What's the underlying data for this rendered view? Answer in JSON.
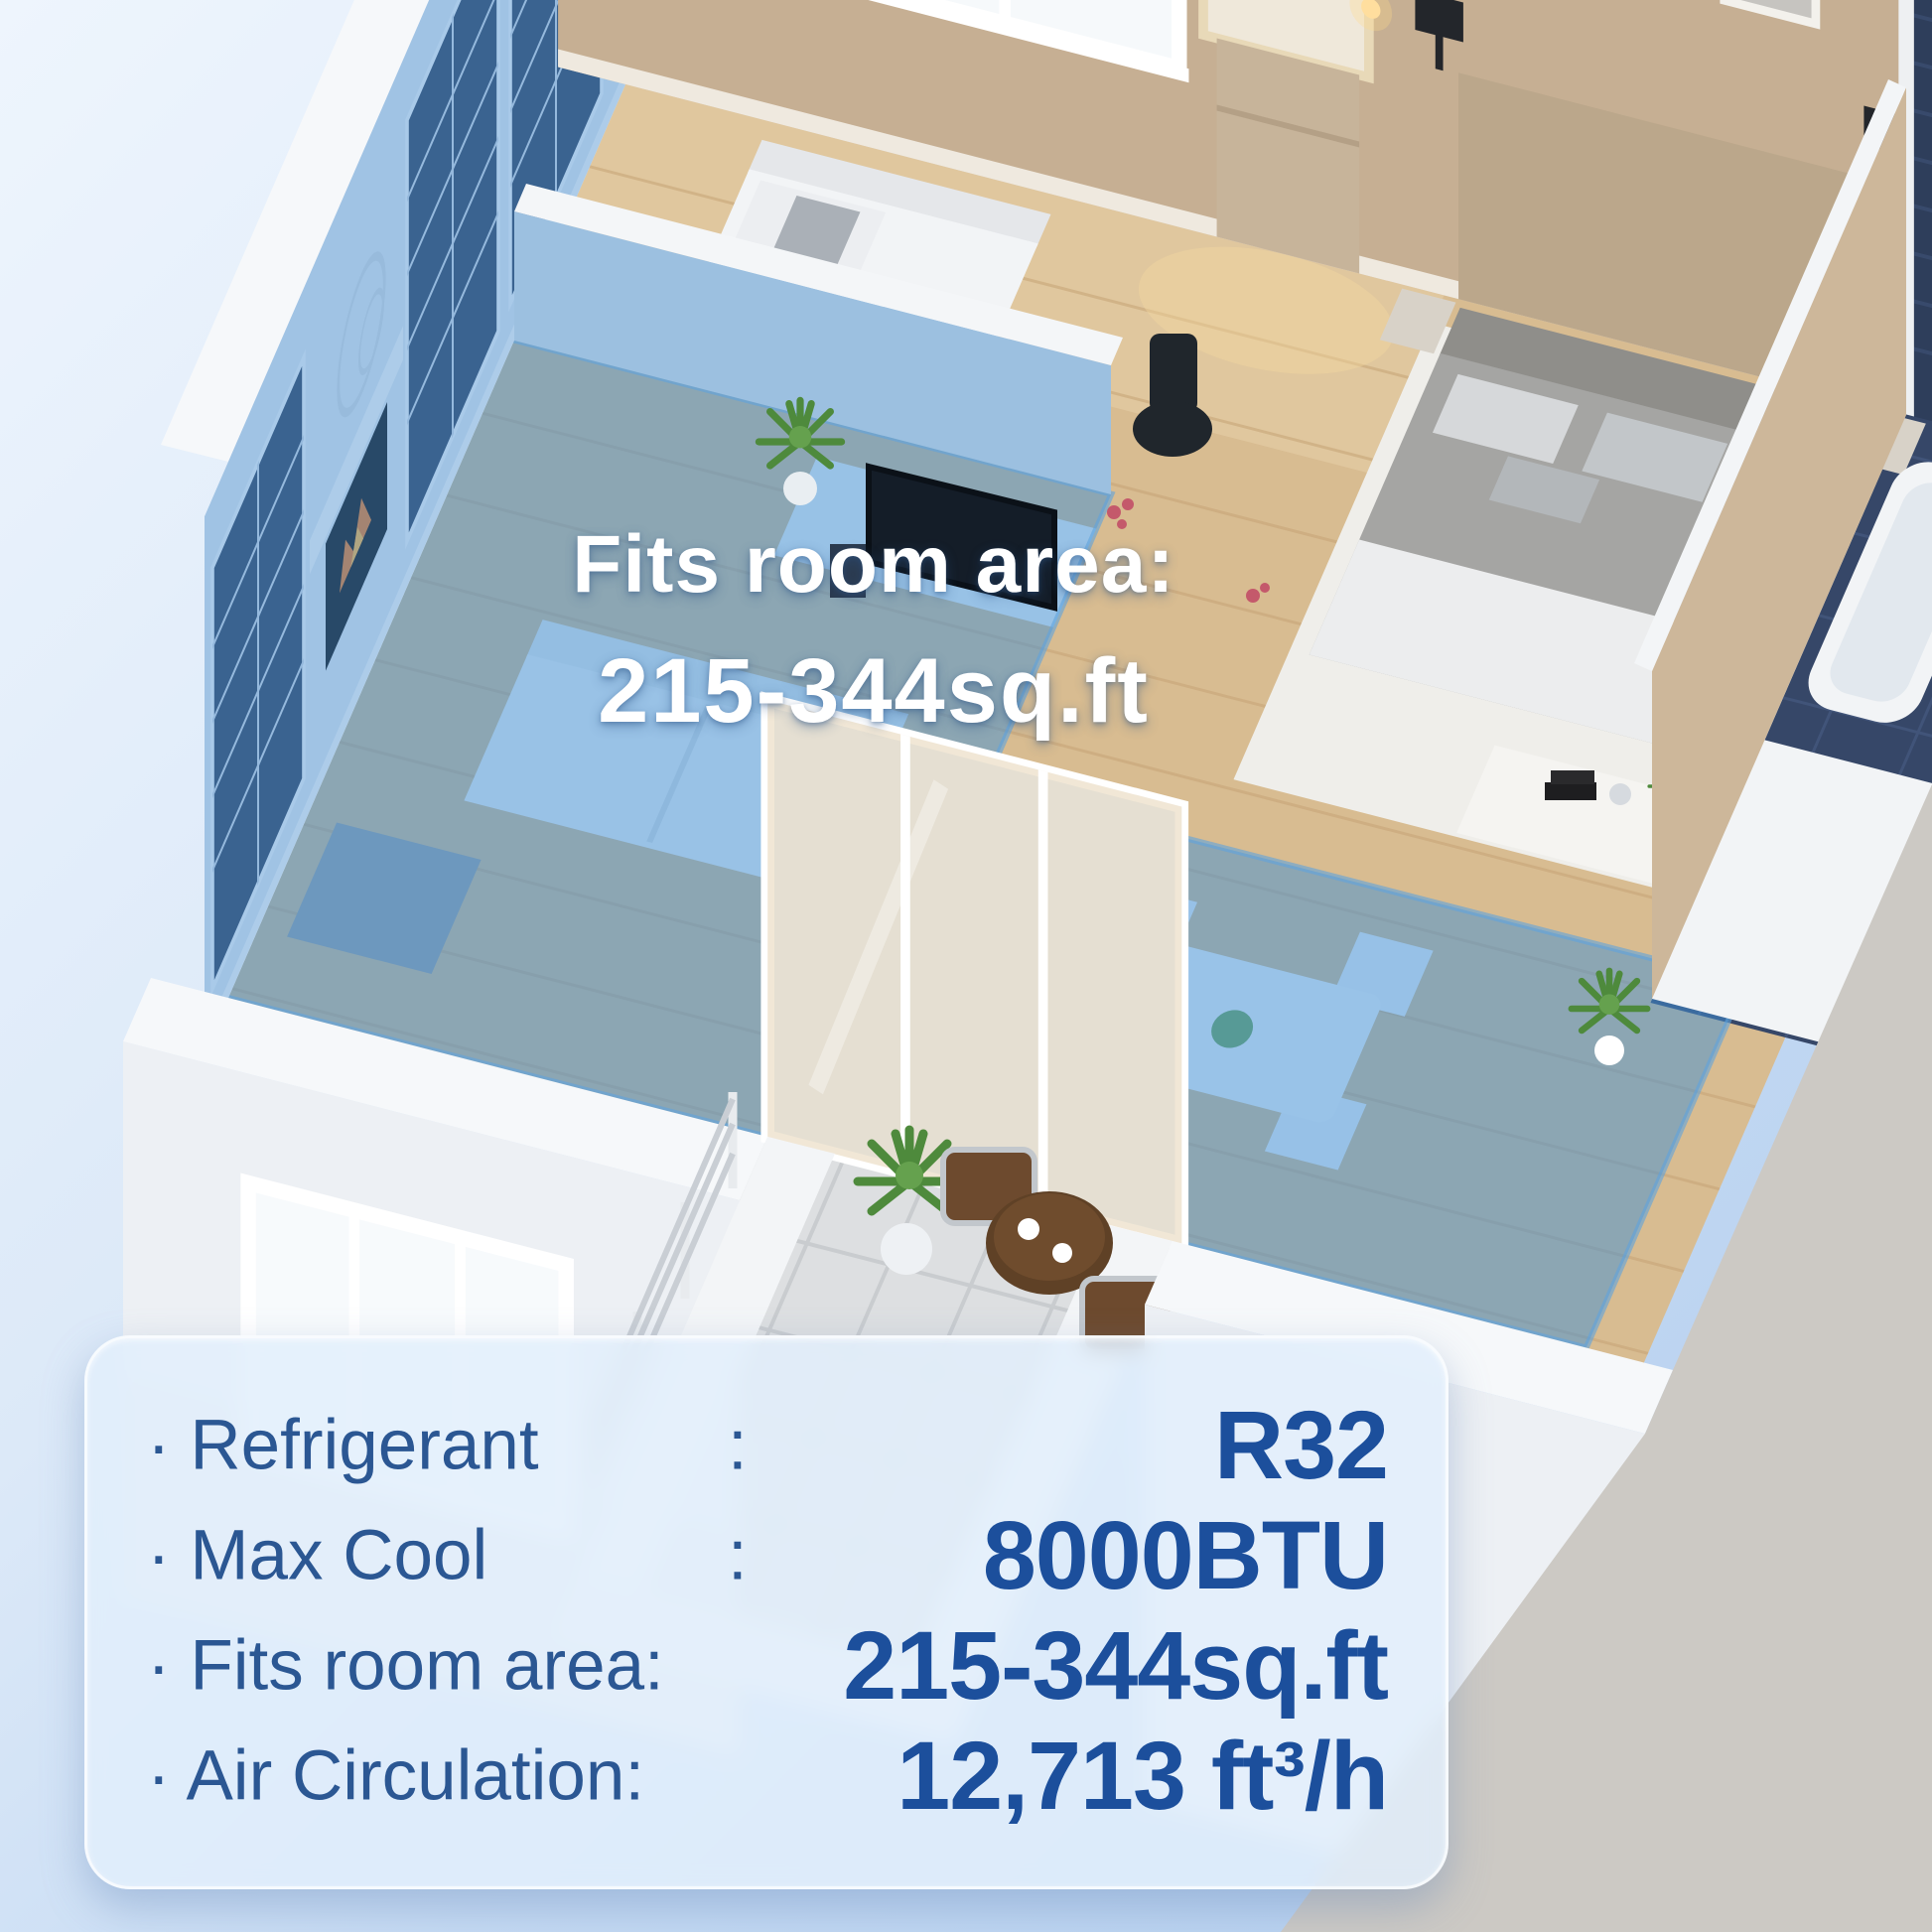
{
  "scene": {
    "description": "isometric apartment cutaway with air-conditioned zone highlighted",
    "overlay": {
      "line1": "Fits room area:",
      "line2": "215-344sq.ft"
    },
    "highlight_color": "#3f90d6",
    "background_top": "#eef5fd",
    "background_bottom": "#b2cdee"
  },
  "specs": {
    "label_color": "#2b5793",
    "value_color": "#1c4f9c",
    "rows": [
      {
        "label": "· Refrigerant",
        "colon": ":",
        "value": "R32"
      },
      {
        "label": "· Max Cool",
        "colon": ":",
        "value": "8000BTU"
      },
      {
        "label": "· Fits room area:",
        "colon": "",
        "value": "215-344sq.ft"
      },
      {
        "label": "· Air Circulation:",
        "colon": "",
        "value": "12,713 ft³/h"
      }
    ]
  }
}
